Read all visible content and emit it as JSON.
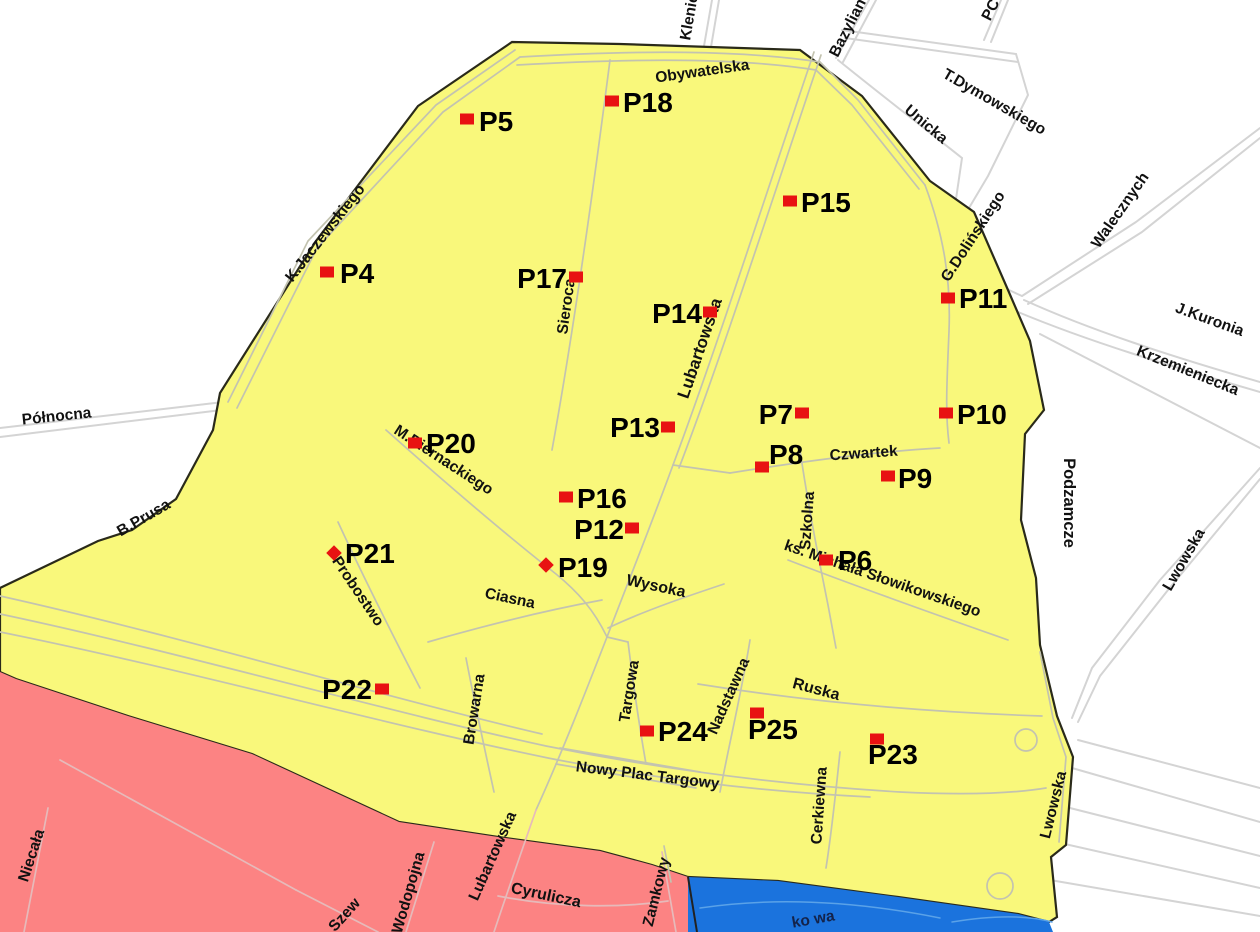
{
  "map": {
    "background": "#ffffff",
    "colors": {
      "zone_yellow": "#f9f87b",
      "zone_pink": "#fc8383",
      "zone_blue": "#1b73dd",
      "boundary": "#2a2a1a",
      "marker_red": "#e81212",
      "road_white_area": "#d4d4d4",
      "road_yellow_area": "#c3c3b0",
      "road_pink_area": "#e6baba",
      "road_blue_area": "#5aa2e8",
      "label_black": "#111111"
    },
    "regions": [
      {
        "name": "zone-yellow",
        "fill": "#f9f87b",
        "stroke": "#2a2a1a",
        "stroke_width": 2.2,
        "points": "512,42 620,44 800,50 862,96 930,181 974,212 1008,290 1030,341 1044,410 1025,434 1021,520 1036,578 1040,645 1057,716 1073,757 1066,845 1051,857 1057,917 1049,922 1018,914 898,897 778,881 688,877 652,865 600,851 498,837 399,822 252,754 128,716 16,679 0,672 0,588 98,541 132,530 176,499 213,430 220,393 316,241 418,106"
      },
      {
        "name": "zone-pink",
        "fill": "#fc8383",
        "stroke": "none",
        "stroke_width": 0,
        "points": "0,672 16,679 128,716 252,754 399,822 498,837 600,851 652,865 688,877 697,932 0,932"
      },
      {
        "name": "zone-blue",
        "fill": "#1b73dd",
        "stroke": "none",
        "stroke_width": 0,
        "points": "688,877 778,881 898,897 1018,914 1049,922 1053,932 688,932"
      }
    ],
    "boundary_lines": [
      {
        "name": "pink-blue-border",
        "d": "M688,877 L697,932",
        "stroke": "#222222",
        "width": 2
      }
    ],
    "roads": {
      "white_area": {
        "color": "#d4d4d4",
        "width": 2,
        "paths": [
          "M0,428 L232,401",
          "M0,437 L230,409",
          "M712,0 L704,46",
          "M719,0 L711,47",
          "M869,0 L836,58",
          "M876,0 L843,62",
          "M1001,0 L984,40",
          "M1008,0 L991,42",
          "M842,30 L1016,54",
          "M845,38 L1018,62",
          "M1016,54 L1028,95 L988,176 L950,240",
          "M838,60 C890,102 932,134 962,158",
          "M962,158 L950,240",
          "M950,240 C965,262 985,280 1022,296",
          "M1260,128 L1136,222 L1022,296",
          "M1260,138 L1142,232 L1028,304",
          "M1024,300 C1090,330 1170,356 1260,382",
          "M1018,312 C1090,342 1170,366 1260,392",
          "M1040,334 L1260,448",
          "M1260,468 L1160,580 L1092,668 L1072,718",
          "M1260,479 L1168,590 L1100,676 L1078,722",
          "M1078,740 L1260,788",
          "M1072,768 L1260,822",
          "M1062,806 L1260,856",
          "M1056,842 L1260,888",
          "M1050,880 L1260,916"
        ]
      },
      "yellow_area": {
        "color": "#c3c3b0",
        "width": 1.7,
        "paths": [
          "M228,402 L308,241 L436,105 L515,50",
          "M237,408 L317,248 L443,112 L520,57",
          "M520,57 C640,50 740,50 820,62",
          "M517,65 C640,58 740,58 816,70",
          "M820,62 L858,100 L925,185",
          "M816,70 L852,105 L919,189",
          "M610,60 C592,200 572,340 552,450",
          "M814,52 C766,194 716,350 673,465 C651,525 629,580 607,637 C586,691 561,755 536,810",
          "M821,55 C773,197 723,353 679,468",
          "M925,185 C944,236 951,281 949,331 C947,381 945,411 949,443",
          "M730,473 C800,462 870,452 940,448",
          "M673,465 L730,473",
          "M800,450 C808,505 818,555 828,605 L836,648",
          "M788,560 C860,588 940,616 1008,640",
          "M698,684 C810,702 920,712 1042,716",
          "M750,640 C742,690 730,740 720,792",
          "M628,642 C634,690 640,730 646,764",
          "M608,628 C646,610 688,596 724,584",
          "M386,430 C440,478 500,530 556,574 C578,592 594,610 607,637",
          "M338,522 C362,574 390,630 420,688",
          "M428,642 C490,624 548,610 602,600",
          "M466,658 C476,710 486,755 494,792",
          "M0,596 C180,636 380,696 542,734",
          "M0,614 C180,652 380,710 546,746 C680,773 800,786 900,792 C960,795 1010,794 1046,788",
          "M0,632 C180,668 382,724 548,758 C660,780 770,792 870,797",
          "M560,748 L700,772",
          "M556,764 L696,788",
          "M840,752 C836,790 832,830 826,868",
          "M664,846 L671,882",
          "M607,637 L628,642",
          "M1040,652 L1053,718 L1066,757 L1059,842"
        ],
        "circles": [
          {
            "cx": 1026,
            "cy": 740,
            "r": 11
          },
          {
            "cx": 1000,
            "cy": 886,
            "r": 13
          }
        ]
      },
      "pink_area": {
        "color": "#e6baba",
        "width": 1.7,
        "paths": [
          "M48,808 L24,932",
          "M60,760 L296,890",
          "M296,890 L378,932",
          "M434,842 L406,932",
          "M536,810 C522,850 508,890 494,932",
          "M498,896 C560,908 620,908 668,901",
          "M662,852 L676,932"
        ]
      },
      "blue_area": {
        "color": "#5aa2e8",
        "width": 1.5,
        "paths": [
          "M700,908 C780,896 860,902 940,918",
          "M952,922 C1000,914 1030,916 1052,922"
        ]
      }
    },
    "street_labels": [
      {
        "text": "Obywatelska",
        "x": 703,
        "y": 76,
        "r": -8
      },
      {
        "text": "Klenie",
        "x": 694,
        "y": 18,
        "r": -80
      },
      {
        "text": "Bazylian",
        "x": 852,
        "y": 30,
        "r": -63
      },
      {
        "text": "PC",
        "x": 995,
        "y": 12,
        "r": -63
      },
      {
        "text": "T.Dymowskiego",
        "x": 992,
        "y": 106,
        "r": 30
      },
      {
        "text": "Unicka",
        "x": 923,
        "y": 128,
        "r": 40
      },
      {
        "text": "Walecznych",
        "x": 1124,
        "y": 213,
        "r": -55
      },
      {
        "text": "G.Dolińskiego",
        "x": 977,
        "y": 239,
        "r": -57
      },
      {
        "text": "J.Kuronia",
        "x": 1208,
        "y": 324,
        "r": 20
      },
      {
        "text": "Krzemieniecka",
        "x": 1186,
        "y": 375,
        "r": 22
      },
      {
        "text": "K.Jaczewskiego",
        "x": 329,
        "y": 236,
        "r": -52
      },
      {
        "text": "Północna",
        "x": 57,
        "y": 421,
        "r": -6
      },
      {
        "text": "Sieroca",
        "x": 571,
        "y": 307,
        "r": -82
      },
      {
        "text": "Lubartowska",
        "x": 705,
        "y": 350,
        "r": -71,
        "s": 17
      },
      {
        "text": "M.Biernackiego",
        "x": 441,
        "y": 464,
        "r": 33
      },
      {
        "text": "Czwartek",
        "x": 864,
        "y": 458,
        "r": -4
      },
      {
        "text": "Szkolna",
        "x": 812,
        "y": 521,
        "r": -86
      },
      {
        "text": "ks. Michała Słowikowskiego",
        "x": 881,
        "y": 583,
        "r": 19
      },
      {
        "text": "B.Prusa",
        "x": 146,
        "y": 522,
        "r": -30
      },
      {
        "text": "Probostwo",
        "x": 354,
        "y": 594,
        "r": 56
      },
      {
        "text": "Ciasna",
        "x": 509,
        "y": 603,
        "r": 12
      },
      {
        "text": "Wysoka",
        "x": 655,
        "y": 591,
        "r": 12,
        "s": 16
      },
      {
        "text": "Browarna",
        "x": 479,
        "y": 710,
        "r": -81
      },
      {
        "text": "Targowa",
        "x": 634,
        "y": 692,
        "r": -81
      },
      {
        "text": "Nadstawna",
        "x": 733,
        "y": 698,
        "r": -66
      },
      {
        "text": "Ruska",
        "x": 815,
        "y": 694,
        "r": 15,
        "s": 16
      },
      {
        "text": "Nowy Plac Targowy",
        "x": 647,
        "y": 780,
        "r": 7
      },
      {
        "text": "Cerkiewna",
        "x": 824,
        "y": 806,
        "r": -86
      },
      {
        "text": "Lwowska",
        "x": 1058,
        "y": 806,
        "r": -76
      },
      {
        "text": "Lwowska",
        "x": 1188,
        "y": 562,
        "r": -60
      },
      {
        "text": "Podzamcze",
        "x": 1064,
        "y": 503,
        "r": 90,
        "s": 16.5
      },
      {
        "text": "Niecała",
        "x": 36,
        "y": 857,
        "r": -72
      },
      {
        "text": "Wodopojna",
        "x": 413,
        "y": 894,
        "r": -74
      },
      {
        "text": "Lubartowska",
        "x": 497,
        "y": 858,
        "r": -66
      },
      {
        "text": "Cyrulicza",
        "x": 545,
        "y": 900,
        "r": 12,
        "s": 16
      },
      {
        "text": "Szew",
        "x": 348,
        "y": 918,
        "r": -48
      },
      {
        "text": "Zamkowy",
        "x": 661,
        "y": 893,
        "r": -76
      },
      {
        "text": "ko wa",
        "x": 814,
        "y": 924,
        "r": -10,
        "c": "#14234a"
      }
    ],
    "markers": {
      "color": "#e81212",
      "label_size": 28,
      "label_color": "#000000",
      "items": [
        {
          "id": "P4",
          "x": 327,
          "y": 272,
          "shape": "sq",
          "lx": 340,
          "ly": 283,
          "anchor": "start"
        },
        {
          "id": "P5",
          "x": 467,
          "y": 119,
          "shape": "sq",
          "lx": 479,
          "ly": 131,
          "anchor": "start"
        },
        {
          "id": "P6",
          "x": 826,
          "y": 560,
          "shape": "sq",
          "lx": 838,
          "ly": 570,
          "anchor": "start"
        },
        {
          "id": "P7",
          "x": 802,
          "y": 413,
          "shape": "sq",
          "lx": 793,
          "ly": 424,
          "anchor": "end"
        },
        {
          "id": "P8",
          "x": 762,
          "y": 467,
          "shape": "sq",
          "lx": 769,
          "ly": 464,
          "anchor": "start"
        },
        {
          "id": "P9",
          "x": 888,
          "y": 476,
          "shape": "sq",
          "lx": 898,
          "ly": 488,
          "anchor": "start"
        },
        {
          "id": "P10",
          "x": 946,
          "y": 413,
          "shape": "sq",
          "lx": 957,
          "ly": 424,
          "anchor": "start"
        },
        {
          "id": "P11",
          "x": 948,
          "y": 298,
          "shape": "sq",
          "lx": 959,
          "ly": 308,
          "anchor": "start"
        },
        {
          "id": "P12",
          "x": 632,
          "y": 528,
          "shape": "sq",
          "lx": 624,
          "ly": 539,
          "anchor": "end"
        },
        {
          "id": "P13",
          "x": 668,
          "y": 427,
          "shape": "sq",
          "lx": 660,
          "ly": 437,
          "anchor": "end"
        },
        {
          "id": "P14",
          "x": 710,
          "y": 312,
          "shape": "sq",
          "lx": 702,
          "ly": 323,
          "anchor": "end"
        },
        {
          "id": "P15",
          "x": 790,
          "y": 201,
          "shape": "sq",
          "lx": 801,
          "ly": 212,
          "anchor": "start"
        },
        {
          "id": "P16",
          "x": 566,
          "y": 497,
          "shape": "sq",
          "lx": 577,
          "ly": 508,
          "anchor": "start"
        },
        {
          "id": "P17",
          "x": 576,
          "y": 277,
          "shape": "sq",
          "lx": 567,
          "ly": 288,
          "anchor": "end"
        },
        {
          "id": "P18",
          "x": 612,
          "y": 101,
          "shape": "sq",
          "lx": 623,
          "ly": 112,
          "anchor": "start"
        },
        {
          "id": "P19",
          "x": 546,
          "y": 565,
          "shape": "di",
          "lx": 558,
          "ly": 577,
          "anchor": "start"
        },
        {
          "id": "P20",
          "x": 415,
          "y": 443,
          "shape": "sq",
          "lx": 426,
          "ly": 453,
          "anchor": "start"
        },
        {
          "id": "P21",
          "x": 334,
          "y": 553,
          "shape": "di",
          "lx": 345,
          "ly": 563,
          "anchor": "start"
        },
        {
          "id": "P22",
          "x": 382,
          "y": 689,
          "shape": "sq",
          "lx": 372,
          "ly": 699,
          "anchor": "end"
        },
        {
          "id": "P23",
          "x": 877,
          "y": 739,
          "shape": "sq",
          "lx": 868,
          "ly": 764,
          "anchor": "start"
        },
        {
          "id": "P24",
          "x": 647,
          "y": 731,
          "shape": "sq",
          "lx": 658,
          "ly": 741,
          "anchor": "start"
        },
        {
          "id": "P25",
          "x": 757,
          "y": 713,
          "shape": "sq",
          "lx": 748,
          "ly": 739,
          "anchor": "start"
        }
      ]
    }
  }
}
